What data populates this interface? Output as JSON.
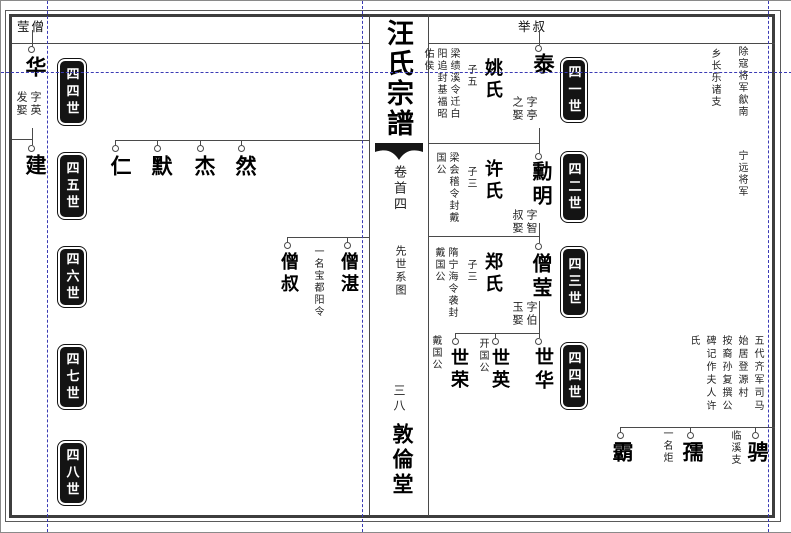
{
  "document_title": "汪氏宗譜 先世系图 (genealogy chart leaf)",
  "spine": {
    "title": "汪氏宗譜",
    "volume": "卷首四",
    "section": "先世系图",
    "page_number": "三八",
    "hall": "敦倫堂"
  },
  "left_page": {
    "header": "莹僧",
    "generations": [
      "四四世",
      "四五世",
      "四六世",
      "四七世",
      "四八世"
    ],
    "hua": {
      "name": "华",
      "note": "字英\n发娶"
    },
    "jian": {
      "name": "建"
    },
    "row2": [
      {
        "name": "仁"
      },
      {
        "name": "默"
      },
      {
        "name": "杰"
      },
      {
        "name": "然"
      }
    ],
    "row3": [
      {
        "name": "僧叔"
      },
      {
        "name": "僧湛",
        "note": "一名宝都阳令"
      }
    ]
  },
  "right_page": {
    "header": "举叔",
    "generations": [
      "四一世",
      "四二世",
      "四三世",
      "四四世"
    ],
    "tai": {
      "name": "泰",
      "note": "字亭\n之娶",
      "wife": "姚氏",
      "sons": "子五",
      "title_note": "梁绩溪令迁白\n阳追封基福昭\n佑侯"
    },
    "xunming": {
      "name": "勳明",
      "note": "字智\n叔娶",
      "wife": "许氏",
      "sons": "子三",
      "title_note": "梁会稽令封戴\n国公"
    },
    "sengying": {
      "name": "僧莹",
      "note": "字伯\n玉娶",
      "wife": "郑氏",
      "sons": "子三",
      "title_note": "隋宁海令袭封\n戴国公"
    },
    "row4": [
      {
        "name": "世荣",
        "note": "戴国公"
      },
      {
        "name": "世英",
        "note": "开国公"
      },
      {
        "name": "世华"
      }
    ],
    "row5": [
      {
        "name": "霸"
      },
      {
        "name": "孺",
        "note": "一名炬"
      },
      {
        "name": "骋",
        "note": "临溪支"
      }
    ],
    "row5_note": "五代齐军司马\n始居登源村\n按裔孙复撰公\n碑记作夫人许\n氏",
    "corner_notes": {
      "a": "除寇将军歙南",
      "b": "宁远将军",
      "c": "乡长乐诸支"
    }
  },
  "colors": {
    "line": "#4a4a4a",
    "guide": "#3b3bb5",
    "badge": "#141414"
  }
}
